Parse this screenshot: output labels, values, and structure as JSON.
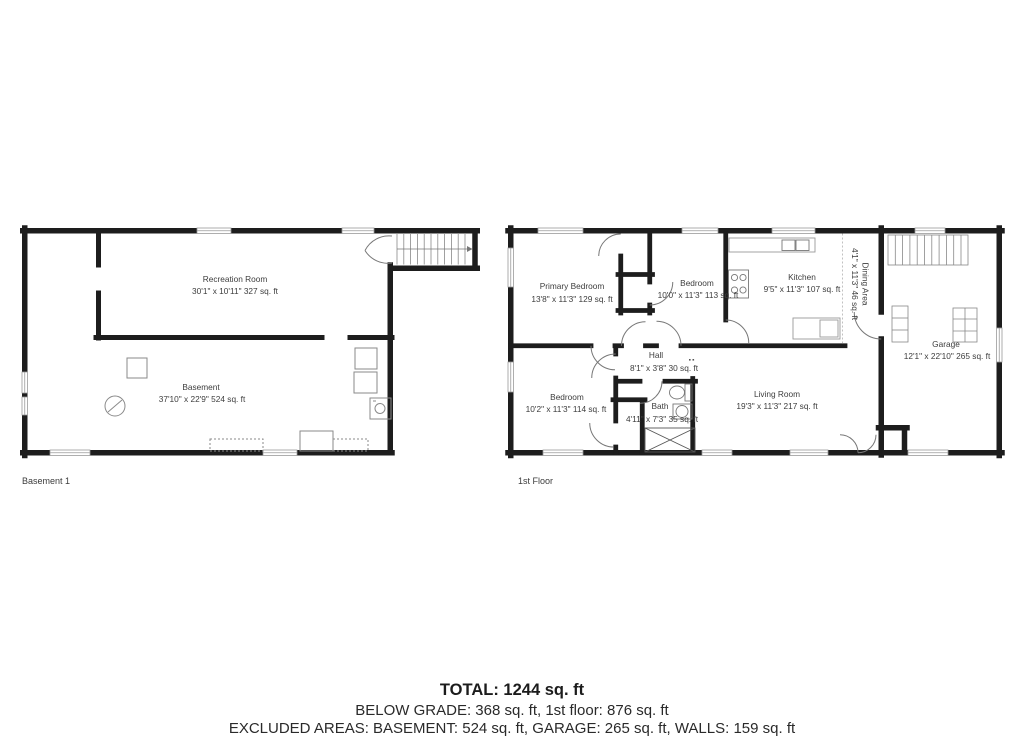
{
  "document": {
    "type": "floorplan-sheet",
    "background": "#ffffff"
  },
  "colors": {
    "wall": "#1d1d1d",
    "label_text": "#3d3d3d",
    "fixture_line": "#8a8a8a",
    "stair_line": "#888888",
    "summary_text": "#1c1c1c"
  },
  "plans": [
    {
      "floor_label": "Basement 1",
      "rooms": [
        {
          "name": "Recreation Room",
          "dims": "30'1\" x 10'11\" 327 sq. ft"
        },
        {
          "name": "Basement",
          "dims": "37'10\" x 22'9\" 524 sq. ft"
        }
      ]
    },
    {
      "floor_label": "1st Floor",
      "rooms": [
        {
          "name": "Primary Bedroom",
          "dims": "13'8\" x 11'3\" 129 sq. ft"
        },
        {
          "name": "Bedroom",
          "dims": "10'0\" x 11'3\" 113 sq. ft"
        },
        {
          "name": "Kitchen",
          "dims": "9'5\" x 11'3\" 107 sq. ft"
        },
        {
          "name": "Dining Area",
          "dims": "4'1\" x 11'3\" 46 sq. ft"
        },
        {
          "name": "Garage",
          "dims": "12'1\" x 22'10\" 265 sq. ft"
        },
        {
          "name": "Hall",
          "dims": "8'1\" x 3'8\" 30 sq. ft"
        },
        {
          "name": "Bedroom",
          "dims": "10'2\" x 11'3\" 114 sq. ft"
        },
        {
          "name": "Bath",
          "dims": "4'11\" x 7'3\" 35 sq. ft"
        },
        {
          "name": "Living Room",
          "dims": "19'3\" x 11'3\" 217 sq. ft"
        }
      ]
    }
  ],
  "summary": {
    "total": "TOTAL: 1244 sq. ft",
    "below_grade": "BELOW GRADE: 368 sq. ft, 1st floor: 876 sq. ft",
    "excluded": "EXCLUDED AREAS: BASEMENT: 524 sq. ft, GARAGE: 265 sq. ft, WALLS: 159 sq. ft"
  }
}
